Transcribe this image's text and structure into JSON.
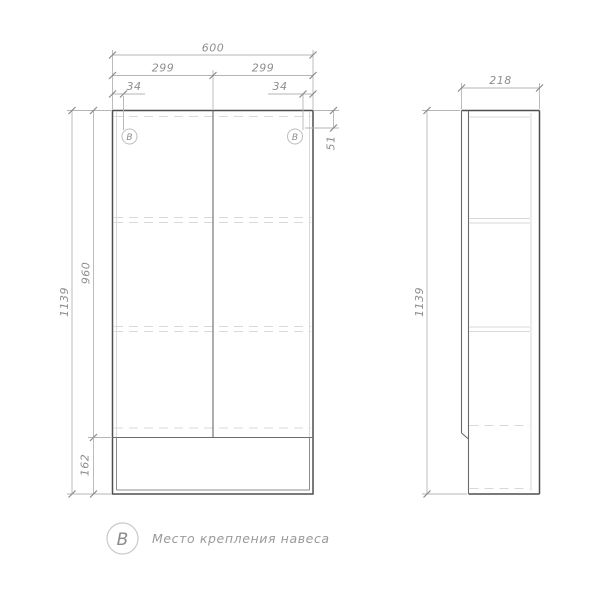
{
  "colors": {
    "outline": "#4f4f4f",
    "hidden": "#d9d9d9",
    "dimension": "#b5b5b5",
    "dimtext": "#8e8e8e",
    "legendtext": "#9a9a9a",
    "bg": "#ffffff"
  },
  "drawing_type": "cabinet-technical-drawing",
  "front_view": {
    "dims": {
      "total_width": "600",
      "left_door_width": "299",
      "right_door_width": "299",
      "left_fastener_offset": "34",
      "right_fastener_offset": "34",
      "fastener_drop": "51",
      "total_height": "1139",
      "door_height": "960",
      "niche_height": "162"
    },
    "fastener_marks": {
      "left": "В",
      "right": "В"
    }
  },
  "side_view": {
    "dims": {
      "depth": "218",
      "total_height": "1139"
    }
  },
  "legend": {
    "symbol": "В",
    "label": "Место крепления навеса"
  }
}
